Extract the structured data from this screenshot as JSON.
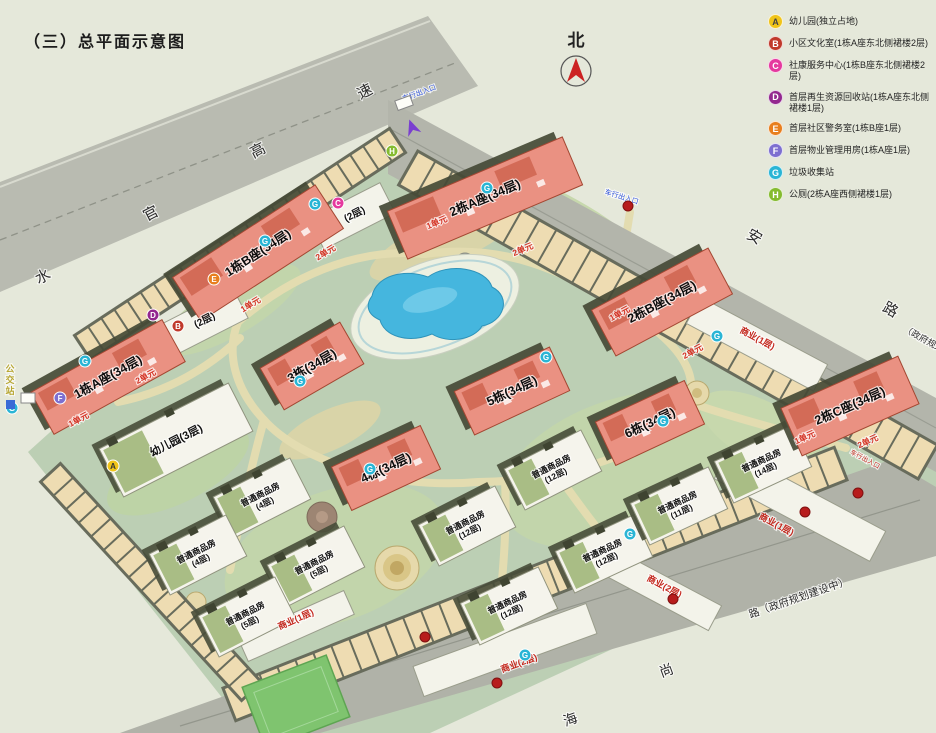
{
  "title": "（三）总平面示意图",
  "north": {
    "label": "北"
  },
  "legend": [
    {
      "key": "A",
      "color": "#f0c419",
      "text": "幼儿园(独立占地)"
    },
    {
      "key": "B",
      "color": "#c0392b",
      "text": "小区文化室(1栋A座东北侧裙楼2层)"
    },
    {
      "key": "C",
      "color": "#e5399e",
      "text": "社康服务中心(1栋B座东北侧裙楼2层)"
    },
    {
      "key": "D",
      "color": "#93278f",
      "text": "首层再生资源回收站(1栋A座东北侧裙楼1层)"
    },
    {
      "key": "E",
      "color": "#e87f1e",
      "text": "首层社区警务室(1栋B座1层)"
    },
    {
      "key": "F",
      "color": "#7d6fd0",
      "text": "首层物业管理用房(1栋A座1层)"
    },
    {
      "key": "G",
      "color": "#2ab5d5",
      "text": "垃圾收集站"
    },
    {
      "key": "H",
      "color": "#85bb2f",
      "text": "公厕(2栋A座西侧裙楼1层)"
    }
  ],
  "colors": {
    "tower": "#ea9182",
    "tower_edge": "#a34732",
    "lowrise": "#f5f4ec",
    "pool": "#45b6de",
    "road": "#b3b5ab",
    "stall": "#eedcb2",
    "site_green": "#bccfb4",
    "unit_red": "#d43425",
    "commercial_red": "#c4281e"
  },
  "towers": [
    {
      "label": "2栋A座(34层)",
      "x": 485,
      "y": 198,
      "w": 190,
      "h": 52,
      "r": -23
    },
    {
      "label": "1栋B座(34层)",
      "x": 258,
      "y": 253,
      "w": 170,
      "h": 52,
      "r": -33
    },
    {
      "label": "1栋A座(34层)",
      "x": 108,
      "y": 377,
      "w": 150,
      "h": 48,
      "r": -29
    },
    {
      "label": "3栋(34层)",
      "x": 312,
      "y": 366,
      "w": 92,
      "h": 48,
      "r": -30
    },
    {
      "label": "5栋(34层)",
      "x": 512,
      "y": 391,
      "w": 105,
      "h": 48,
      "r": -25
    },
    {
      "label": "6栋(34层)",
      "x": 650,
      "y": 423,
      "w": 98,
      "h": 48,
      "r": -25
    },
    {
      "label": "4栋(34层)",
      "x": 386,
      "y": 468,
      "w": 98,
      "h": 48,
      "r": -25
    },
    {
      "label": "2栋B座(34层)",
      "x": 662,
      "y": 302,
      "w": 132,
      "h": 52,
      "r": -28
    },
    {
      "label": "2栋C座(34层)",
      "x": 850,
      "y": 406,
      "w": 128,
      "h": 52,
      "r": -24
    }
  ],
  "lowrise": [
    {
      "l1": "幼儿园(3层)",
      "l2": "",
      "x": 176,
      "y": 440,
      "w": 145,
      "h": 54,
      "r": -27,
      "big": 1
    },
    {
      "l1": "普通商品房",
      "l2": "(4层)",
      "x": 262,
      "y": 498,
      "w": 86,
      "h": 46,
      "r": -27
    },
    {
      "l1": "普通商品房",
      "l2": "(4层)",
      "x": 198,
      "y": 555,
      "w": 86,
      "h": 46,
      "r": -27
    },
    {
      "l1": "普通商品房",
      "l2": "(5层)",
      "x": 316,
      "y": 566,
      "w": 86,
      "h": 46,
      "r": -27
    },
    {
      "l1": "普通商品房",
      "l2": "(5层)",
      "x": 247,
      "y": 617,
      "w": 86,
      "h": 46,
      "r": -27
    },
    {
      "l1": "普通商品房",
      "l2": "(12层)",
      "x": 553,
      "y": 470,
      "w": 86,
      "h": 46,
      "r": -27
    },
    {
      "l1": "普通商品房",
      "l2": "(12层)",
      "x": 467,
      "y": 526,
      "w": 86,
      "h": 46,
      "r": -27
    },
    {
      "l1": "普通商品房",
      "l2": "(12层)",
      "x": 604,
      "y": 554,
      "w": 86,
      "h": 46,
      "r": -25
    },
    {
      "l1": "普通商品房",
      "l2": "(12层)",
      "x": 509,
      "y": 606,
      "w": 86,
      "h": 46,
      "r": -25
    },
    {
      "l1": "普通商品房",
      "l2": "(14层)",
      "x": 763,
      "y": 464,
      "w": 86,
      "h": 46,
      "r": -25
    },
    {
      "l1": "普通商品房",
      "l2": "(11层)",
      "x": 679,
      "y": 506,
      "w": 86,
      "h": 46,
      "r": -25
    }
  ],
  "texts": [
    {
      "t": "水",
      "x": 45,
      "y": 281,
      "r": -27,
      "s": 15,
      "c": "#2b2b2b",
      "n": "road-label-expressway"
    },
    {
      "t": "官",
      "x": 153,
      "y": 218,
      "r": -27,
      "s": 15,
      "c": "#2b2b2b",
      "n": "road-label-expressway"
    },
    {
      "t": "高",
      "x": 260,
      "y": 155,
      "r": -27,
      "s": 15,
      "c": "#2b2b2b",
      "n": "road-label-expressway"
    },
    {
      "t": "速",
      "x": 367,
      "y": 96,
      "r": -27,
      "s": 15,
      "c": "#2b2b2b",
      "n": "road-label-expressway"
    },
    {
      "t": "安",
      "x": 752,
      "y": 241,
      "r": 29,
      "s": 15,
      "c": "#2b2b2b",
      "n": "road-label-northeast"
    },
    {
      "t": "路",
      "x": 888,
      "y": 314,
      "r": 29,
      "s": 15,
      "c": "#2b2b2b",
      "n": "road-label-northeast"
    },
    {
      "t": "（政府规划中）",
      "x": 930,
      "y": 346,
      "r": 29,
      "s": 9,
      "c": "#2b2b2b",
      "n": "road-label-northeast"
    },
    {
      "t": "海",
      "x": 572,
      "y": 724,
      "r": -20,
      "s": 14,
      "c": "#2b2b2b",
      "n": "road-label-southeast"
    },
    {
      "t": "尚",
      "x": 668,
      "y": 675,
      "r": -20,
      "s": 14,
      "c": "#2b2b2b",
      "n": "road-label-southeast"
    },
    {
      "t": "路（政府规划建设中）",
      "x": 800,
      "y": 601,
      "r": -19,
      "s": 10.5,
      "c": "#2b2b2b",
      "n": "road-label-southeast"
    },
    {
      "t": "(2层)",
      "x": 356,
      "y": 217,
      "r": -27,
      "s": 10,
      "c": "#111111",
      "b": 1,
      "n": "podium-label"
    },
    {
      "t": "(2层)",
      "x": 206,
      "y": 323,
      "r": -27,
      "s": 10,
      "c": "#111111",
      "b": 1,
      "n": "podium-label"
    },
    {
      "t": "商业(1层)",
      "x": 756,
      "y": 341,
      "r": 28,
      "s": 9,
      "c": "#c4281e",
      "b": 1,
      "n": "commercial-label"
    },
    {
      "t": "商业(1层)",
      "x": 775,
      "y": 527,
      "r": 28,
      "s": 9,
      "c": "#c4281e",
      "b": 1,
      "n": "commercial-label"
    },
    {
      "t": "商业(2层)",
      "x": 663,
      "y": 589,
      "r": 28,
      "s": 9,
      "c": "#c4281e",
      "b": 1,
      "n": "commercial-label"
    },
    {
      "t": "商业(2层)",
      "x": 520,
      "y": 666,
      "r": -20,
      "s": 9,
      "c": "#c4281e",
      "b": 1,
      "n": "commercial-label"
    },
    {
      "t": "商业(1层)",
      "x": 297,
      "y": 622,
      "r": -24,
      "s": 9,
      "c": "#c4281e",
      "b": 1,
      "n": "commercial-label"
    },
    {
      "t": "1单元",
      "x": 80,
      "y": 422,
      "r": -28,
      "s": 8.5,
      "c": "#d43425",
      "b": 1,
      "n": "unit-label"
    },
    {
      "t": "2单元",
      "x": 147,
      "y": 379,
      "r": -28,
      "s": 8.5,
      "c": "#d43425",
      "b": 1,
      "n": "unit-label"
    },
    {
      "t": "1单元",
      "x": 252,
      "y": 307,
      "r": -31,
      "s": 8.5,
      "c": "#d43425",
      "b": 1,
      "n": "unit-label"
    },
    {
      "t": "2单元",
      "x": 327,
      "y": 255,
      "r": -31,
      "s": 8.5,
      "c": "#d43425",
      "b": 1,
      "n": "unit-label"
    },
    {
      "t": "1单元",
      "x": 438,
      "y": 225,
      "r": -23,
      "s": 8.5,
      "c": "#d43425",
      "b": 1,
      "n": "unit-label"
    },
    {
      "t": "2单元",
      "x": 524,
      "y": 252,
      "r": -23,
      "s": 8.5,
      "c": "#d43425",
      "b": 1,
      "n": "unit-label"
    },
    {
      "t": "1单元",
      "x": 621,
      "y": 316,
      "r": -28,
      "s": 8.5,
      "c": "#d43425",
      "b": 1,
      "n": "unit-label"
    },
    {
      "t": "2单元",
      "x": 694,
      "y": 354,
      "r": -28,
      "s": 8.5,
      "c": "#d43425",
      "b": 1,
      "n": "unit-label"
    },
    {
      "t": "1单元",
      "x": 806,
      "y": 440,
      "r": -24,
      "s": 8.5,
      "c": "#d43425",
      "b": 1,
      "n": "unit-label"
    },
    {
      "t": "2单元",
      "x": 869,
      "y": 444,
      "r": -24,
      "s": 8.5,
      "c": "#d43425",
      "b": 1,
      "n": "unit-label"
    },
    {
      "t": "车行出入口",
      "x": 420,
      "y": 95,
      "r": -20,
      "s": 7,
      "c": "#2b4fd8",
      "n": "entrance-label"
    },
    {
      "t": "车行出入口",
      "x": 621,
      "y": 199,
      "r": 17,
      "s": 7,
      "c": "#2b4fd8",
      "n": "entrance-label"
    },
    {
      "t": "车行出入口",
      "x": 864,
      "y": 461,
      "r": 28,
      "s": 6.5,
      "c": "#c2281e",
      "n": "entrance-label"
    },
    {
      "t": "公",
      "x": 10,
      "y": 372,
      "s": 9,
      "c": "#b7a733",
      "b": 1,
      "n": "bus-stop-label"
    },
    {
      "t": "交",
      "x": 10,
      "y": 383,
      "s": 9,
      "c": "#b7a733",
      "b": 1,
      "n": "bus-stop-label"
    },
    {
      "t": "站",
      "x": 10,
      "y": 394,
      "s": 9,
      "c": "#b7a733",
      "b": 1,
      "n": "bus-stop-label"
    }
  ],
  "badges": [
    {
      "k": "A",
      "x": 113,
      "y": 466
    },
    {
      "k": "B",
      "x": 178,
      "y": 326
    },
    {
      "k": "C",
      "x": 338,
      "y": 203
    },
    {
      "k": "D",
      "x": 153,
      "y": 315
    },
    {
      "k": "E",
      "x": 214,
      "y": 279
    },
    {
      "k": "F",
      "x": 60,
      "y": 398
    },
    {
      "k": "H",
      "x": 392,
      "y": 151
    },
    {
      "k": "G",
      "x": 85,
      "y": 361
    },
    {
      "k": "G",
      "x": 265,
      "y": 241
    },
    {
      "k": "G",
      "x": 315,
      "y": 204
    },
    {
      "k": "G",
      "x": 487,
      "y": 188
    },
    {
      "k": "G",
      "x": 300,
      "y": 381
    },
    {
      "k": "G",
      "x": 546,
      "y": 357
    },
    {
      "k": "G",
      "x": 663,
      "y": 421
    },
    {
      "k": "G",
      "x": 370,
      "y": 469
    },
    {
      "k": "G",
      "x": 717,
      "y": 336
    },
    {
      "k": "G",
      "x": 630,
      "y": 534
    },
    {
      "k": "G",
      "x": 525,
      "y": 655
    },
    {
      "k": "G",
      "x": 12,
      "y": 408
    }
  ],
  "entry_dots": [
    {
      "x": 425,
      "y": 637
    },
    {
      "x": 497,
      "y": 683
    },
    {
      "x": 673,
      "y": 599
    },
    {
      "x": 805,
      "y": 512
    },
    {
      "x": 858,
      "y": 493
    },
    {
      "x": 628,
      "y": 206
    }
  ],
  "parking_bands": [
    {
      "x": 240,
      "y": 244,
      "len": 380,
      "w": 32,
      "r": -33.3,
      "n": 24
    },
    {
      "x": 668,
      "y": 315,
      "len": 600,
      "w": 42,
      "r": 29.5,
      "n": 30
    },
    {
      "x": 535,
      "y": 584,
      "len": 660,
      "w": 38,
      "r": -21.5,
      "n": 34
    },
    {
      "x": 151,
      "y": 582,
      "len": 300,
      "w": 30,
      "r": 47.4,
      "n": 16
    }
  ]
}
